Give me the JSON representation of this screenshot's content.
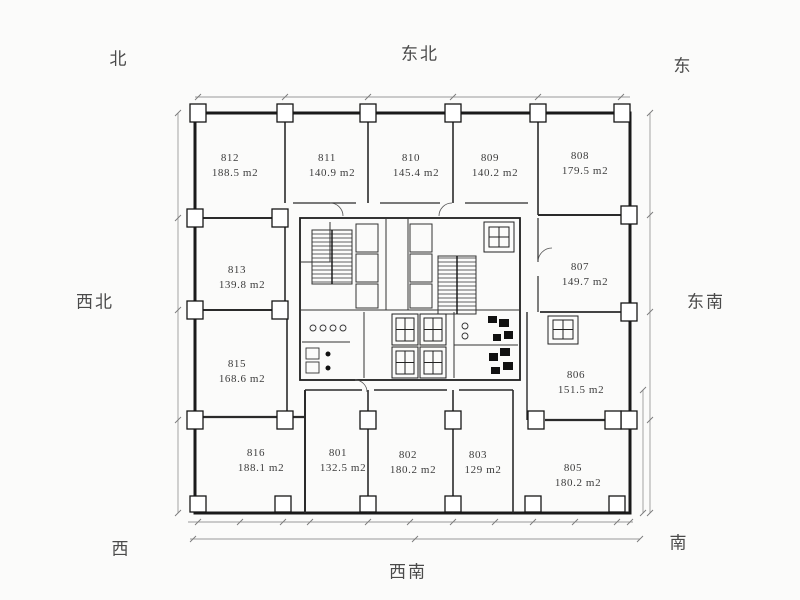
{
  "title": "office-floor-plan",
  "compass": {
    "north": "北",
    "northeast": "东北",
    "east": "东",
    "northwest": "西北",
    "southeast": "东南",
    "west": "西",
    "southwest": "西南",
    "south": "南"
  },
  "rooms": [
    {
      "number": "812",
      "area": "188.5 m2"
    },
    {
      "number": "811",
      "area": "140.9 m2"
    },
    {
      "number": "810",
      "area": "145.4 m2"
    },
    {
      "number": "809",
      "area": "140.2 m2"
    },
    {
      "number": "808",
      "area": "179.5 m2"
    },
    {
      "number": "813",
      "area": "139.8 m2"
    },
    {
      "number": "807",
      "area": "149.7 m2"
    },
    {
      "number": "815",
      "area": "168.6 m2"
    },
    {
      "number": "806",
      "area": "151.5 m2"
    },
    {
      "number": "816",
      "area": "188.1 m2"
    },
    {
      "number": "801",
      "area": "132.5 m2"
    },
    {
      "number": "802",
      "area": "180.2 m2"
    },
    {
      "number": "803",
      "area": "129 m2"
    },
    {
      "number": "805",
      "area": "180.2 m2"
    }
  ],
  "colors": {
    "wall": "#1a1a1a",
    "partition": "#2a2a2a",
    "dimension_line": "#9a9a9a",
    "label_text": "#3c3c3c",
    "background": "#fbfbfa"
  }
}
